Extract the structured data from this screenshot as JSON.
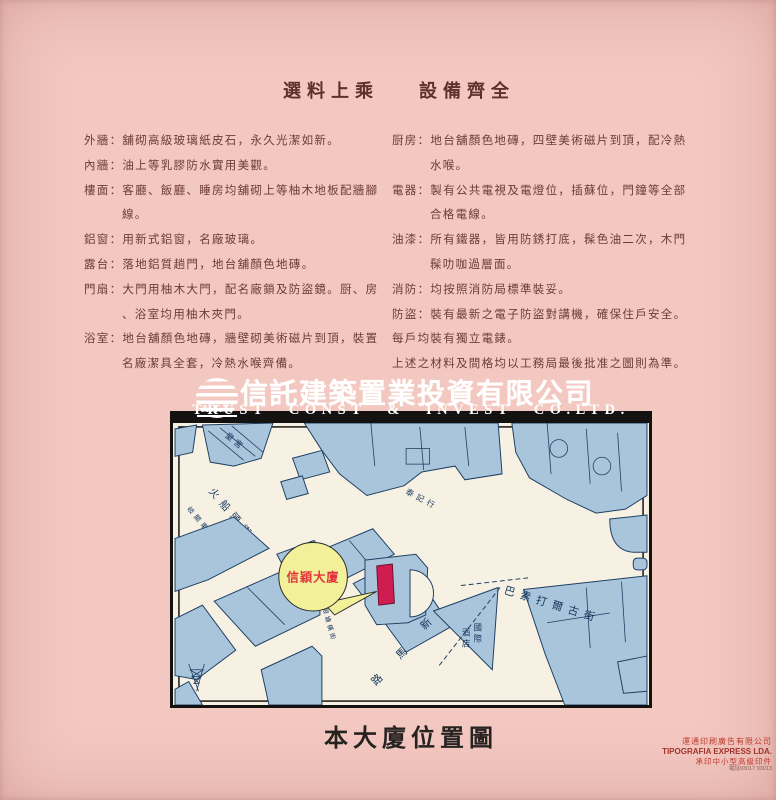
{
  "theme": {
    "page-bg": "#f3c8c1",
    "ink": "#6d3c35",
    "header-ink": "#5e322c",
    "map-paper": "#f6f1e2",
    "map-building": "#a9c5db",
    "map-outline": "#1e3f63",
    "highlight": "#cf1d52",
    "callout-bg": "#f3f09a",
    "callout-text": "#e4333c",
    "printer-red": "#c03a30"
  },
  "headers": {
    "left": "選料上乘",
    "right": "設備齊全"
  },
  "specs": {
    "left": [
      {
        "t": "外牆：舖砌高級玻璃紙皮石，永久光潔如新。",
        "cls": ""
      },
      {
        "t": "內牆：油上等乳膠防水實用美觀。",
        "cls": ""
      },
      {
        "t": "樓面：客廳、飯廳、睡房均舖砌上等柚木地板配牆腳",
        "cls": ""
      },
      {
        "t": "線。",
        "cls": "cont"
      },
      {
        "t": "鋁窗：用新式鋁窗，名廠玻璃。",
        "cls": ""
      },
      {
        "t": "露台：落地鋁質趟門，地台舖顏色地磚。",
        "cls": ""
      },
      {
        "t": "門扇：大門用柚木大門，配名廠鎖及防盜鏡。厨、房",
        "cls": ""
      },
      {
        "t": "、浴室均用柚木夾門。",
        "cls": "cont"
      },
      {
        "t": "浴室：地台舖顏色地磚，牆壁砌美術磁片到頂，裝置",
        "cls": ""
      },
      {
        "t": "名廠潔具全套，冷熱水喉齊備。",
        "cls": "cont"
      }
    ],
    "right": [
      {
        "t": "厨房：地台舖顏色地磚，四壁美術磁片到頂，配冷熱",
        "cls": ""
      },
      {
        "t": "水喉。",
        "cls": "cont"
      },
      {
        "t": "電器：製有公共電視及電燈位，插蘇位，門鐘等全部",
        "cls": ""
      },
      {
        "t": "合格電線。",
        "cls": "cont"
      },
      {
        "t": "油漆：所有鐵器，皆用防銹打底，髹色油二次，木門",
        "cls": ""
      },
      {
        "t": "髹叻咖過層面。",
        "cls": "cont"
      },
      {
        "t": "消防：均按照消防局標準裝妥。",
        "cls": ""
      },
      {
        "t": "防盜：裝有最新之電子防盜對講機，確保住戶安全。",
        "cls": ""
      },
      {
        "t": "每戶均裝有獨立電錶。",
        "cls": ""
      },
      {
        "t": "上述之材料及間格均以工務局最後批准之圖則為準。",
        "cls": ""
      }
    ]
  },
  "brand": {
    "logo_text": "A.T.T.",
    "name_cn": "信託建築置業投資有限公司",
    "name_en": "TRUST CONST & INVEST CO.LTD."
  },
  "map": {
    "labels": {
      "palace": "皇宮",
      "street_firehead": "火船頭街",
      "bus_terminal": "岐關車站",
      "hong": "泰記行",
      "street_baso": "巴素打爾古街",
      "callout": "信穎大廈",
      "lane_white": "白眼塘橫街",
      "street_new_road": "新馬路",
      "hotel_col_right": "國際",
      "hotel_col_left": "酒店"
    }
  },
  "caption": "本大廈位置圖",
  "printer": {
    "line1": "運通印刷廣告有限公司",
    "line2": "TIPOGRAFIA EXPRESS LDA.",
    "line3": "承印中小型高級印件",
    "line4": "電話93017 93013"
  }
}
